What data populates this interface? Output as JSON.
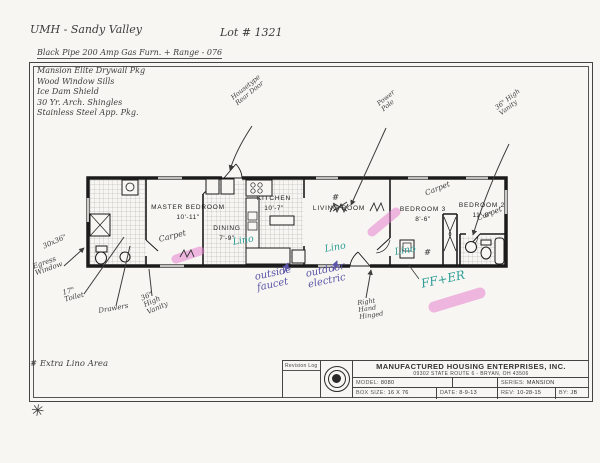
{
  "header": {
    "community": "UMH - Sandy Valley",
    "lot": "Lot # 1321"
  },
  "specs": {
    "top_line": "Black Pipe 200 Amp Gas Furn. + Range - 076",
    "item1": "Mansion Elite Drywall Pkg",
    "item2": "Wood Window Sills",
    "item3": "Ice Dam Shield",
    "item4": "30 Yr. Arch. Shingles",
    "item5": "Stainless Steel App. Pkg."
  },
  "rooms": {
    "master": {
      "name": "MASTER BEDROOM",
      "size": "10'-11\""
    },
    "dining": {
      "name": "DINING",
      "size": "7'-9\""
    },
    "kitchen": {
      "name": "KITCHEN",
      "size": "10'-7\""
    },
    "living": {
      "name": "LIVING ROOM",
      "size": ""
    },
    "bedroom3": {
      "name": "BEDROOM 3",
      "size": "8'-6\""
    },
    "bedroom2": {
      "name": "BEDROOM 2",
      "size": "11'-8\""
    }
  },
  "annotations": {
    "rear_door": "Housetype\nRear Door",
    "power_pole": "Power\nPole",
    "vanity_high_right": "36\" High\nVanity",
    "egress_size": "30x36\"",
    "egress_window": "Egress\nWindow",
    "toilet_17": "17\"\nToilet",
    "drawers": "Drawers",
    "vanity_high_left": "36\"\nHigh\nVanity",
    "extra_lino_area": "# Extra Lino Area",
    "outside_faucet": "outside\nfaucet",
    "outdoor_electric": "outdoor\nelectric",
    "right_hand_hinged": "Right\nHand\nHinged",
    "ff_er": "FF+ER",
    "lino": "Lino",
    "carpet": "Carpet",
    "hash": "#",
    "asterisk": "✳"
  },
  "title_block": {
    "revision_log": "Revision Log",
    "company": "MANUFACTURED HOUSING ENTERPRISES, INC.",
    "address": "09302 STATE ROUTE 6 - BRYAN, OH 43506",
    "model_label": "MODEL:",
    "model_value": "8080",
    "series_label": "SERIES:",
    "series_value": "MANSION",
    "box_label": "BOX SIZE:",
    "box_value": "16 X 76",
    "date_label": "DATE:",
    "date_value": "8-9-13",
    "rev_label": "REV:",
    "rev_value": "10-28-15",
    "by_label": "BY:",
    "by_value": "JB"
  },
  "colors": {
    "highlighter_pink": "#e87fd0",
    "ink_teal": "#2f9e96",
    "ink_purple": "#5b55a8",
    "pencil": "#3c3c3c"
  }
}
